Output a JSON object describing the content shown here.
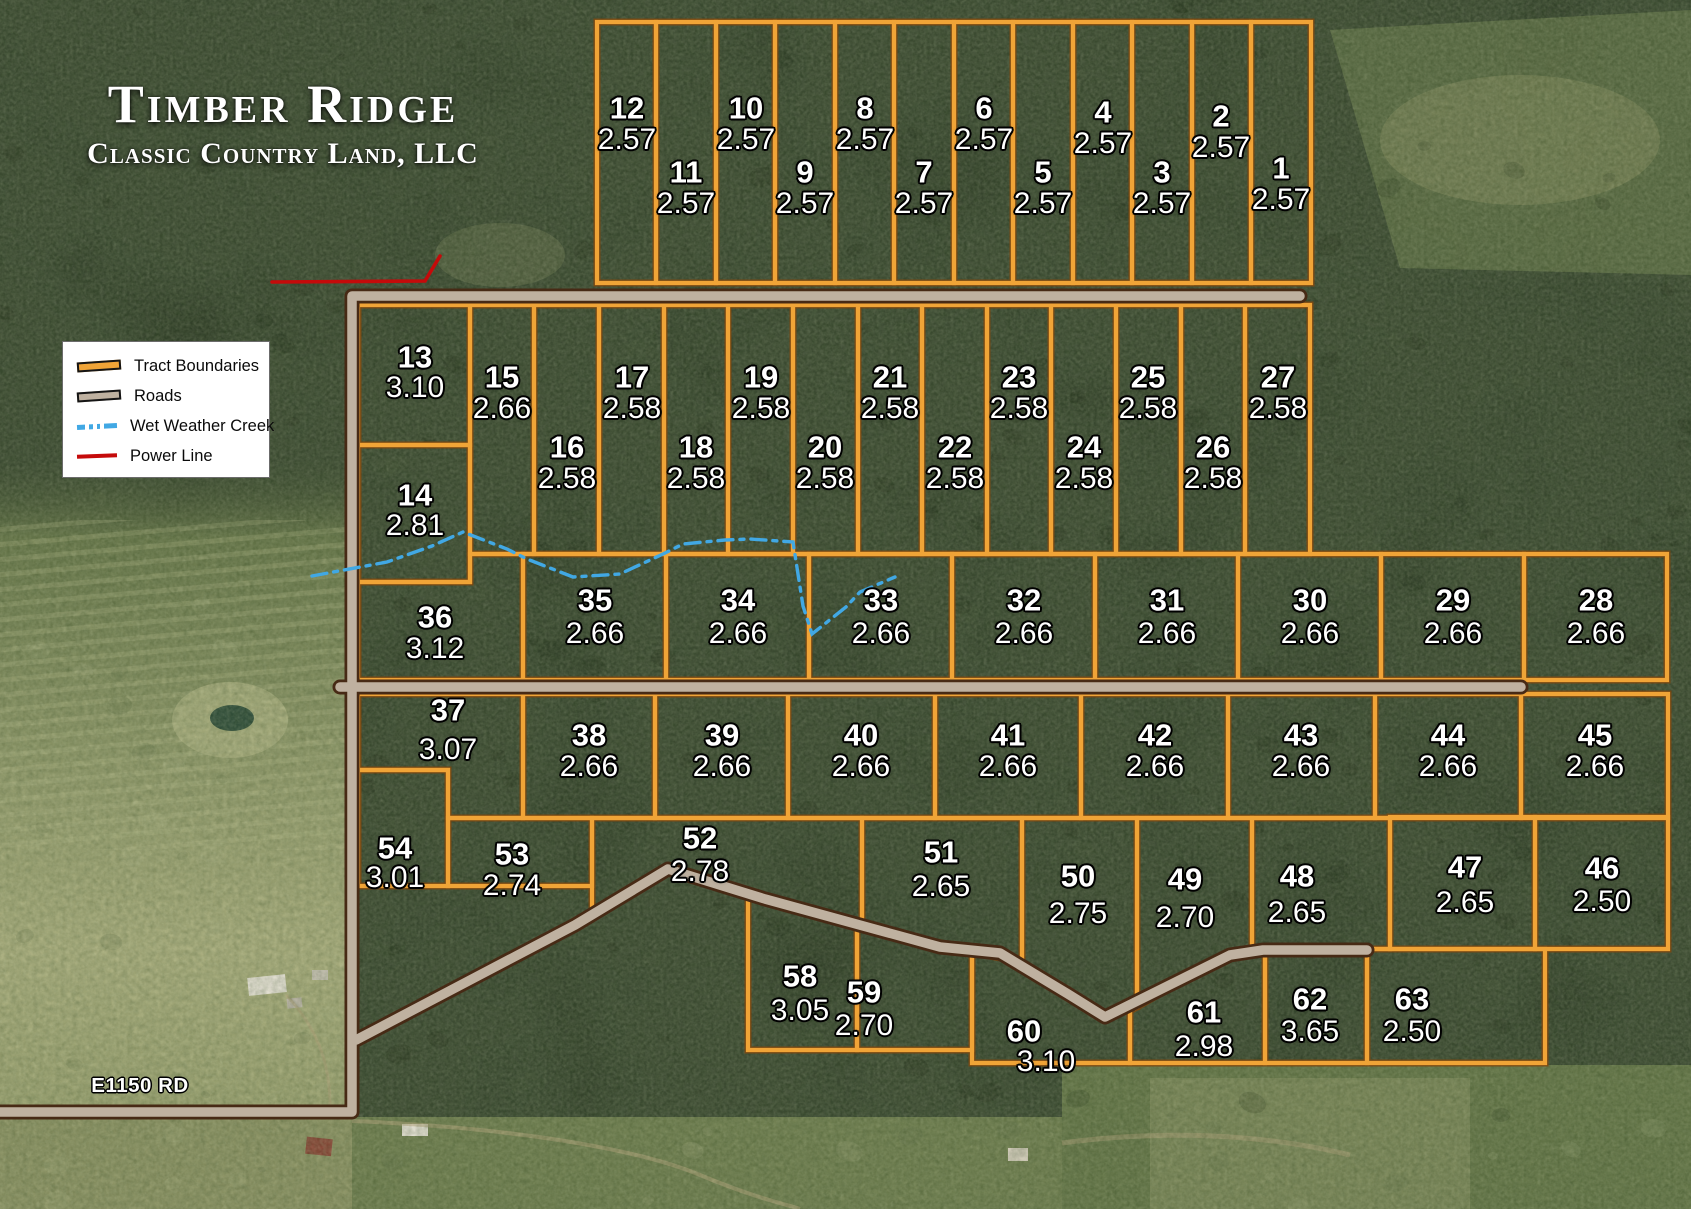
{
  "title": {
    "main": "Timber Ridge",
    "subtitle": "Classic Country Land, LLC"
  },
  "legend": {
    "items": [
      {
        "type": "tract",
        "label": "Tract Boundaries"
      },
      {
        "type": "road",
        "label": "Roads"
      },
      {
        "type": "creek",
        "label": "Wet Weather Creek"
      },
      {
        "type": "power",
        "label": "Power Line"
      }
    ]
  },
  "road_label": "E1150 RD",
  "colors": {
    "tract_boundary": "#F0A437",
    "tract_boundary_edge": "#7A4711",
    "road_fill": "#BFB1A0",
    "road_edge": "#472A15",
    "creek": "#41A8E4",
    "power_line": "#C50A0A",
    "label_text": "#FFFFFF"
  },
  "tracts": [
    {
      "n": "12",
      "acres": "2.57",
      "rect": [
        597,
        22,
        656,
        283
      ],
      "label": [
        627,
        108
      ]
    },
    {
      "n": "11",
      "acres": "2.57",
      "rect": [
        656,
        22,
        716,
        283
      ],
      "label": [
        686,
        172
      ]
    },
    {
      "n": "10",
      "acres": "2.57",
      "rect": [
        716,
        22,
        775,
        283
      ],
      "label": [
        746,
        108
      ]
    },
    {
      "n": "9",
      "acres": "2.57",
      "rect": [
        775,
        22,
        835,
        283
      ],
      "label": [
        805,
        172
      ]
    },
    {
      "n": "8",
      "acres": "2.57",
      "rect": [
        835,
        22,
        894,
        283
      ],
      "label": [
        865,
        108
      ]
    },
    {
      "n": "7",
      "acres": "2.57",
      "rect": [
        894,
        22,
        954,
        283
      ],
      "label": [
        924,
        172
      ]
    },
    {
      "n": "6",
      "acres": "2.57",
      "rect": [
        954,
        22,
        1013,
        283
      ],
      "label": [
        984,
        108
      ]
    },
    {
      "n": "5",
      "acres": "2.57",
      "rect": [
        1013,
        22,
        1073,
        283
      ],
      "label": [
        1043,
        172
      ]
    },
    {
      "n": "4",
      "acres": "2.57",
      "rect": [
        1073,
        22,
        1132,
        283
      ],
      "label": [
        1103,
        112
      ]
    },
    {
      "n": "3",
      "acres": "2.57",
      "rect": [
        1132,
        22,
        1192,
        283
      ],
      "label": [
        1162,
        172
      ]
    },
    {
      "n": "2",
      "acres": "2.57",
      "rect": [
        1192,
        22,
        1251,
        283
      ],
      "label": [
        1221,
        116
      ]
    },
    {
      "n": "1",
      "acres": "2.57",
      "rect": [
        1251,
        22,
        1311,
        283
      ],
      "label": [
        1281,
        168
      ]
    },
    {
      "n": "13",
      "acres": "3.10",
      "rect": [
        358,
        305,
        470,
        445
      ],
      "label": [
        415,
        357
      ],
      "dy": 31
    },
    {
      "n": "14",
      "acres": "2.81",
      "rect": [
        358,
        445,
        470,
        582
      ],
      "label": [
        415,
        495
      ],
      "dy": 31
    },
    {
      "n": "15",
      "acres": "2.66",
      "rect": [
        470,
        305,
        534,
        554
      ],
      "label": [
        502,
        377
      ]
    },
    {
      "n": "16",
      "acres": "2.58",
      "rect": [
        534,
        305,
        599,
        554
      ],
      "label": [
        567,
        447
      ]
    },
    {
      "n": "17",
      "acres": "2.58",
      "rect": [
        599,
        305,
        664,
        554
      ],
      "label": [
        632,
        377
      ]
    },
    {
      "n": "18",
      "acres": "2.58",
      "rect": [
        664,
        305,
        728,
        554
      ],
      "label": [
        696,
        447
      ]
    },
    {
      "n": "19",
      "acres": "2.58",
      "rect": [
        728,
        305,
        793,
        554
      ],
      "label": [
        761,
        377
      ]
    },
    {
      "n": "20",
      "acres": "2.58",
      "rect": [
        793,
        305,
        858,
        554
      ],
      "label": [
        825,
        447
      ]
    },
    {
      "n": "21",
      "acres": "2.58",
      "rect": [
        858,
        305,
        922,
        554
      ],
      "label": [
        890,
        377
      ]
    },
    {
      "n": "22",
      "acres": "2.58",
      "rect": [
        922,
        305,
        987,
        554
      ],
      "label": [
        955,
        447
      ]
    },
    {
      "n": "23",
      "acres": "2.58",
      "rect": [
        987,
        305,
        1051,
        554
      ],
      "label": [
        1019,
        377
      ]
    },
    {
      "n": "24",
      "acres": "2.58",
      "rect": [
        1051,
        305,
        1116,
        554
      ],
      "label": [
        1084,
        447
      ]
    },
    {
      "n": "25",
      "acres": "2.58",
      "rect": [
        1116,
        305,
        1181,
        554
      ],
      "label": [
        1148,
        377
      ]
    },
    {
      "n": "26",
      "acres": "2.58",
      "rect": [
        1181,
        305,
        1245,
        554
      ],
      "label": [
        1213,
        447
      ]
    },
    {
      "n": "27",
      "acres": "2.58",
      "rect": [
        1245,
        305,
        1310,
        554
      ],
      "label": [
        1278,
        377
      ]
    },
    {
      "n": "36",
      "acres": "3.12",
      "poly": [
        [
          358,
          582
        ],
        [
          470,
          582
        ],
        [
          470,
          554
        ],
        [
          523,
          554
        ],
        [
          523,
          680
        ],
        [
          358,
          680
        ]
      ],
      "label": [
        435,
        617
      ]
    },
    {
      "n": "35",
      "acres": "2.66",
      "rect": [
        523,
        554,
        666,
        680
      ],
      "label": [
        595,
        600
      ],
      "dy": 34
    },
    {
      "n": "34",
      "acres": "2.66",
      "rect": [
        666,
        554,
        809,
        680
      ],
      "label": [
        738,
        600
      ],
      "dy": 34
    },
    {
      "n": "33",
      "acres": "2.66",
      "rect": [
        809,
        554,
        952,
        680
      ],
      "label": [
        881,
        600
      ],
      "dy": 34
    },
    {
      "n": "32",
      "acres": "2.66",
      "rect": [
        952,
        554,
        1095,
        680
      ],
      "label": [
        1024,
        600
      ],
      "dy": 34
    },
    {
      "n": "31",
      "acres": "2.66",
      "rect": [
        1095,
        554,
        1238,
        680
      ],
      "label": [
        1167,
        600
      ],
      "dy": 34
    },
    {
      "n": "30",
      "acres": "2.66",
      "rect": [
        1238,
        554,
        1381,
        680
      ],
      "label": [
        1310,
        600
      ],
      "dy": 34
    },
    {
      "n": "29",
      "acres": "2.66",
      "rect": [
        1381,
        554,
        1524,
        680
      ],
      "label": [
        1453,
        600
      ],
      "dy": 34
    },
    {
      "n": "28",
      "acres": "2.66",
      "rect": [
        1524,
        554,
        1667,
        680
      ],
      "label": [
        1596,
        600
      ],
      "dy": 34
    },
    {
      "n": "37",
      "acres": "3.07",
      "poly": [
        [
          358,
          694
        ],
        [
          523,
          694
        ],
        [
          523,
          818
        ],
        [
          448,
          818
        ],
        [
          448,
          770
        ],
        [
          358,
          770
        ]
      ],
      "label": [
        448,
        710
      ],
      "dy": 40
    },
    {
      "n": "38",
      "acres": "2.66",
      "rect": [
        523,
        694,
        655,
        818
      ],
      "label": [
        589,
        735
      ]
    },
    {
      "n": "39",
      "acres": "2.66",
      "rect": [
        655,
        694,
        788,
        818
      ],
      "label": [
        722,
        735
      ]
    },
    {
      "n": "40",
      "acres": "2.66",
      "rect": [
        788,
        694,
        935,
        818
      ],
      "label": [
        861,
        735
      ]
    },
    {
      "n": "41",
      "acres": "2.66",
      "rect": [
        935,
        694,
        1081,
        818
      ],
      "label": [
        1008,
        735
      ]
    },
    {
      "n": "42",
      "acres": "2.66",
      "rect": [
        1081,
        694,
        1228,
        818
      ],
      "label": [
        1155,
        735
      ]
    },
    {
      "n": "43",
      "acres": "2.66",
      "rect": [
        1228,
        694,
        1375,
        818
      ],
      "label": [
        1301,
        735
      ]
    },
    {
      "n": "44",
      "acres": "2.66",
      "rect": [
        1375,
        694,
        1521,
        818
      ],
      "label": [
        1448,
        735
      ]
    },
    {
      "n": "45",
      "acres": "2.66",
      "rect": [
        1521,
        694,
        1668,
        818
      ],
      "label": [
        1595,
        735
      ]
    },
    {
      "n": "54",
      "acres": "3.01",
      "rect": [
        358,
        770,
        448,
        886
      ],
      "label": [
        395,
        848
      ],
      "dy": 30
    },
    {
      "n": "53",
      "acres": "2.74",
      "rect": [
        448,
        818,
        592,
        886
      ],
      "label": [
        512,
        854
      ],
      "dy": 32
    },
    {
      "n": "52",
      "acres": "2.78",
      "poly": [
        [
          592,
          818
        ],
        [
          862,
          818
        ],
        [
          862,
          929
        ],
        [
          765,
          899
        ],
        [
          668,
          869
        ],
        [
          592,
          913
        ]
      ],
      "label": [
        700,
        838
      ],
      "dy": 34
    },
    {
      "n": "51",
      "acres": "2.65",
      "poly": [
        [
          862,
          818
        ],
        [
          1022,
          818
        ],
        [
          1022,
          962
        ],
        [
          940,
          947
        ],
        [
          862,
          929
        ]
      ],
      "label": [
        941,
        852
      ],
      "dy": 35
    },
    {
      "n": "50",
      "acres": "2.75",
      "poly": [
        [
          1022,
          818
        ],
        [
          1137,
          818
        ],
        [
          1137,
          1007
        ],
        [
          1105,
          1017
        ],
        [
          1068,
          994
        ],
        [
          1022,
          962
        ]
      ],
      "label": [
        1078,
        876
      ],
      "dy": 38
    },
    {
      "n": "49",
      "acres": "2.70",
      "poly": [
        [
          1137,
          818
        ],
        [
          1252,
          818
        ],
        [
          1252,
          949
        ],
        [
          1230,
          954
        ],
        [
          1137,
          1007
        ]
      ],
      "label": [
        1185,
        879
      ],
      "dy": 39
    },
    {
      "n": "48",
      "acres": "2.65",
      "poly": [
        [
          1252,
          818
        ],
        [
          1390,
          818
        ],
        [
          1390,
          949
        ],
        [
          1252,
          949
        ]
      ],
      "label": [
        1297,
        876
      ],
      "dy": 37
    },
    {
      "n": "47",
      "acres": "2.65",
      "rect": [
        1390,
        817,
        1535,
        949
      ],
      "label": [
        1465,
        867
      ],
      "dy": 36
    },
    {
      "n": "46",
      "acres": "2.50",
      "rect": [
        1535,
        817,
        1668,
        949
      ],
      "label": [
        1602,
        868
      ],
      "dy": 34
    },
    {
      "n": "58",
      "acres": "3.05",
      "poly": [
        [
          748,
          896
        ],
        [
          857,
          924
        ],
        [
          857,
          1050
        ],
        [
          748,
          1050
        ]
      ],
      "label": [
        800,
        976
      ],
      "dy": 35
    },
    {
      "n": "59",
      "acres": "2.70",
      "poly": [
        [
          857,
          924
        ],
        [
          972,
          950
        ],
        [
          972,
          1050
        ],
        [
          857,
          1050
        ]
      ],
      "label": [
        864,
        992
      ],
      "dy": 34
    },
    {
      "n": "60",
      "acres": "3.10",
      "poly": [
        [
          972,
          950
        ],
        [
          1000,
          953
        ],
        [
          1068,
          994
        ],
        [
          1105,
          1017
        ],
        [
          1130,
          1003
        ],
        [
          1130,
          1063
        ],
        [
          972,
          1063
        ]
      ],
      "label": [
        1024,
        1031
      ],
      "dy": 31,
      "ax": 22
    },
    {
      "n": "61",
      "acres": "2.98",
      "poly": [
        [
          1130,
          1003
        ],
        [
          1230,
          954
        ],
        [
          1265,
          950
        ],
        [
          1265,
          1063
        ],
        [
          1130,
          1063
        ]
      ],
      "label": [
        1204,
        1012
      ],
      "dy": 35
    },
    {
      "n": "62",
      "acres": "3.65",
      "rect": [
        1265,
        950,
        1367,
        1063
      ],
      "label": [
        1310,
        999
      ],
      "dy": 33
    },
    {
      "n": "63",
      "acres": "2.50",
      "rect": [
        1367,
        949,
        1545,
        1063
      ],
      "label": [
        1412,
        999
      ],
      "dy": 33
    }
  ],
  "map": {
    "roads": [
      {
        "name": "perimeter-road",
        "d": "M 0,1112 L 352,1112 L 352,296 L 1300,296"
      },
      {
        "name": "middle-road",
        "d": "M 340,687 L 1521,687"
      },
      {
        "name": "south-road",
        "d": "M 356,1040 L 575,925 L 668,869 L 765,899 L 940,947 L 1000,953 L 1068,994 L 1105,1017 L 1230,955 L 1263,950 L 1367,950"
      }
    ],
    "creek_path": "M 312,576 L 387,562 L 432,546 L 463,532 L 507,549 L 527,559 L 573,577 L 620,574 L 663,554 L 683,544 L 725,540 L 750,539 L 793,542 L 803,606 L 812,634 L 846,607 L 860,592 L 895,577",
    "power_line_path": "M 272,282 L 425,281 L 440,256"
  }
}
